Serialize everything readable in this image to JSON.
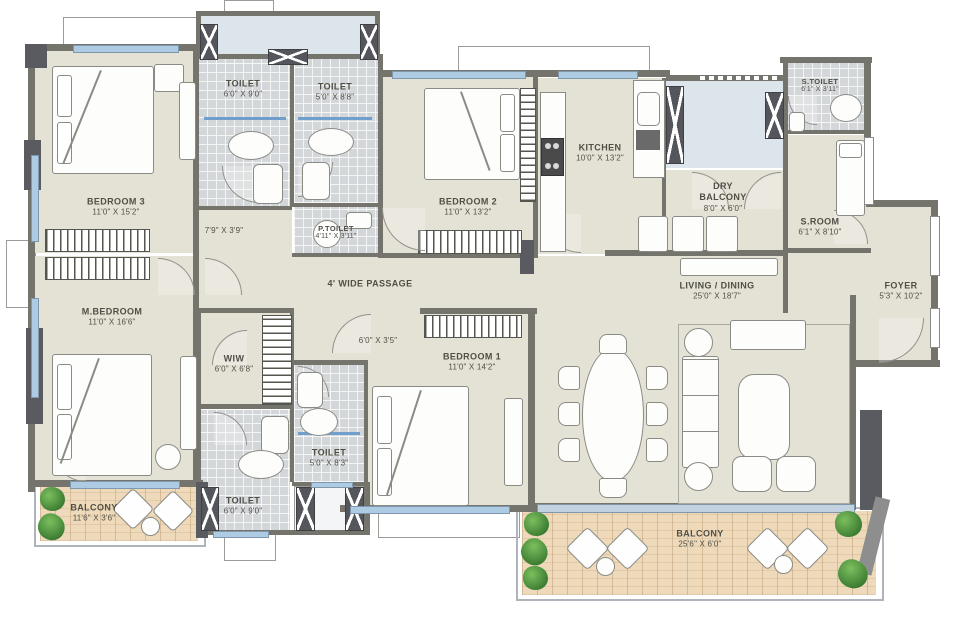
{
  "plan_title": "apartment-floor-plan",
  "colors": {
    "floor": "#e4e1d5",
    "tile": "#d4d7d9",
    "wood": "#eed9ba",
    "shaft": "#dde5ec",
    "wall": "#74746d",
    "column": "#55565c",
    "window": "#aecbe4",
    "text": "#504f46",
    "plant": "#3f8034"
  },
  "rooms": {
    "bedroom3": {
      "name": "BEDROOM 3",
      "dims": "11'0\" X 15'2\""
    },
    "toilet_bed3": {
      "name": "TOILET",
      "dims": "6'0\" X 9'0\""
    },
    "toilet_top": {
      "name": "TOILET",
      "dims": "5'0\" X 8'8\""
    },
    "p_toilet": {
      "name": "P.TOILET",
      "dims": "4'11\" X 3'11\""
    },
    "bedroom2": {
      "name": "BEDROOM 2",
      "dims": "11'0\" X 13'2\""
    },
    "kitchen": {
      "name": "KITCHEN",
      "dims": "10'0\" X 13'2\""
    },
    "dry_balcony": {
      "name": "DRY BALCONY",
      "dims": "8'0\" X 6'0\""
    },
    "s_toilet": {
      "name": "S.TOILET",
      "dims": "6'1\" X 3'11\""
    },
    "s_room": {
      "name": "S.ROOM",
      "dims": "6'1\" X 8'10\""
    },
    "foyer": {
      "name": "FOYER",
      "dims": "5'3\" X 10'2\""
    },
    "living_dining": {
      "name": "LIVING / DINING",
      "dims": "25'0\" X 18'7\""
    },
    "m_bedroom": {
      "name": "M.BEDROOM",
      "dims": "11'0\" X 16'6\""
    },
    "wiw": {
      "name": "WIW",
      "dims": "6'0\" X 6'8\""
    },
    "toilet_mid": {
      "name": "TOILET",
      "dims": "5'0\" X 8'3\""
    },
    "toilet_bottom": {
      "name": "TOILET",
      "dims": "6'0\" X 9'0\""
    },
    "bedroom1": {
      "name": "BEDROOM 1",
      "dims": "11'0\" X 14'2\""
    },
    "balcony_left": {
      "name": "BALCONY",
      "dims": "11'6\" X 3'6\""
    },
    "balcony_main": {
      "name": "BALCONY",
      "dims": "25'6\" X 6'0\""
    }
  },
  "passages": {
    "wide": "4' WIDE PASSAGE",
    "p1": "7'9\" X 3'9\"",
    "p2": "6'0\" X 3'5\""
  }
}
